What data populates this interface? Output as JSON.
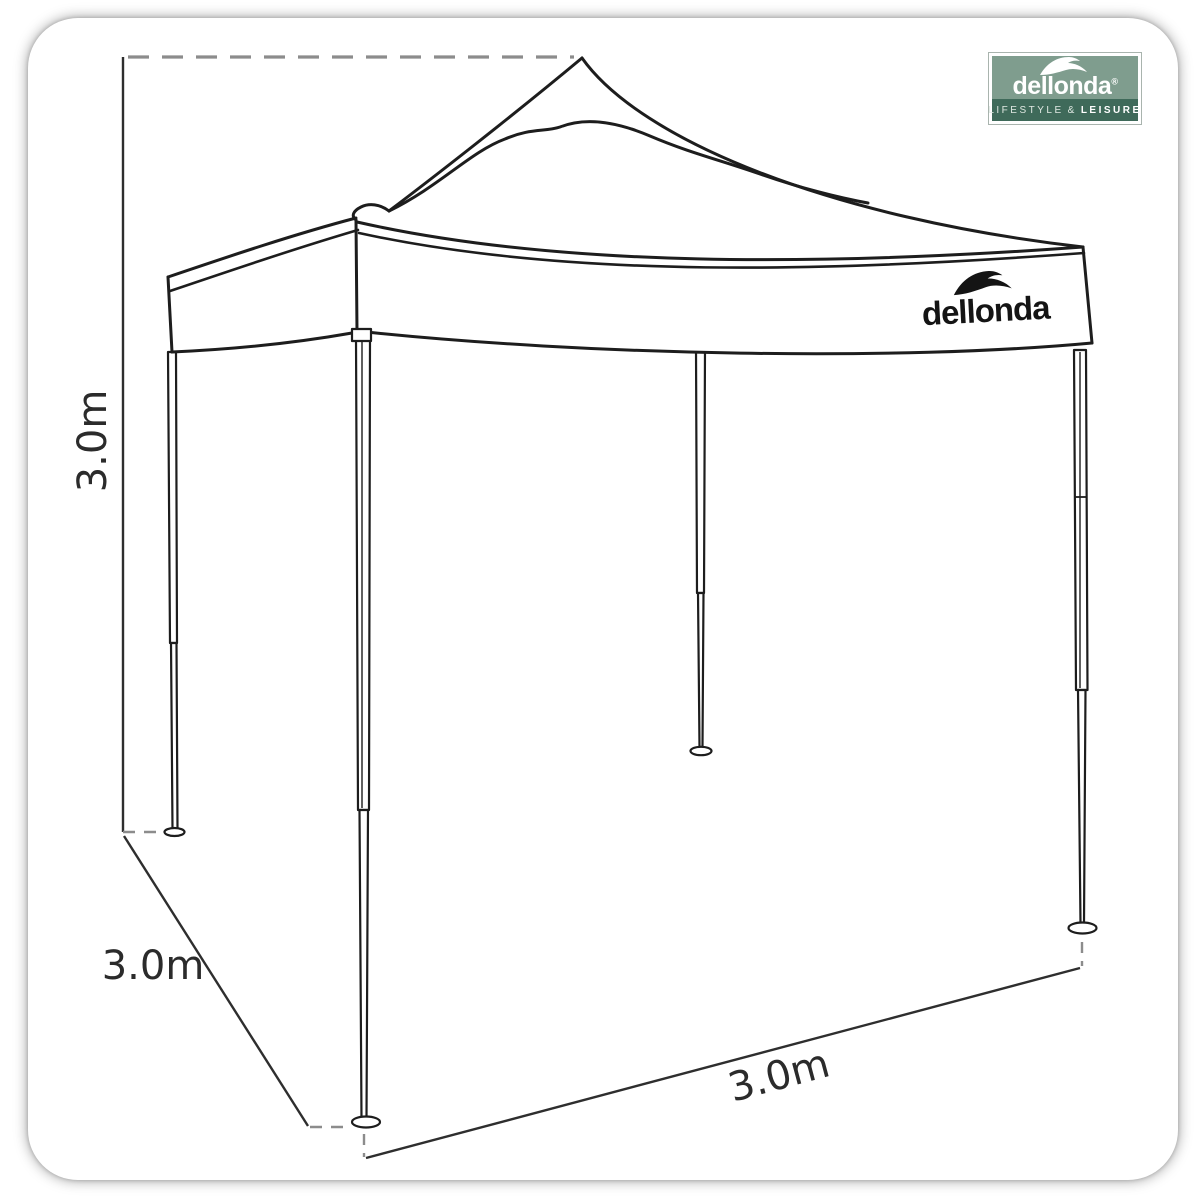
{
  "product_diagram": {
    "dimensions": {
      "height": "3.0m",
      "depth": "3.0m",
      "width": "3.0m"
    }
  },
  "canopy_logo": {
    "brand": "dellonda"
  },
  "brand_badge": {
    "brand": "dellonda",
    "registered_mark": "®",
    "tagline": {
      "left": "LIFESTYLE",
      "separator": "&",
      "right": "LEISURE"
    },
    "colors": {
      "panel": "#7f9d8e",
      "band": "#3f6a5a",
      "text": "#ffffff"
    }
  },
  "drawing": {
    "stroke_color": "#1d1d1d",
    "dimension_line_color": "#2e2e2e",
    "dash_color": "#8c8c8c",
    "icon": "dellonda-wave-icon"
  }
}
